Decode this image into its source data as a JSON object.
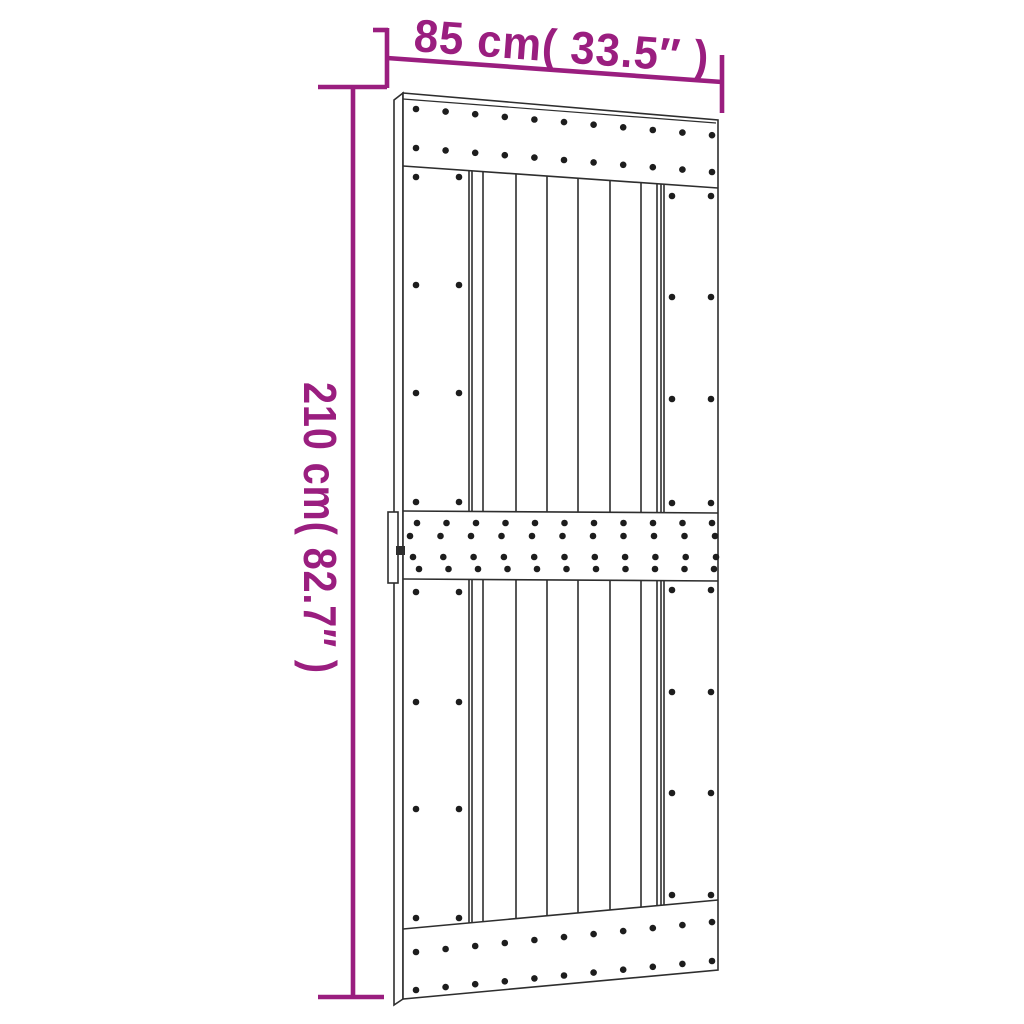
{
  "diagram": {
    "subject": "barn-door-dimension-drawing",
    "width_dimension": {
      "label": "85 cm( 33.5″ )"
    },
    "height_dimension": {
      "label": "210 cm( 82.7″ )"
    },
    "colors": {
      "dimension_accent": "#9a1e7f",
      "line_art": "#2e2e2e",
      "nail_dots": "#1d1d1d",
      "background": "#ffffff"
    }
  }
}
